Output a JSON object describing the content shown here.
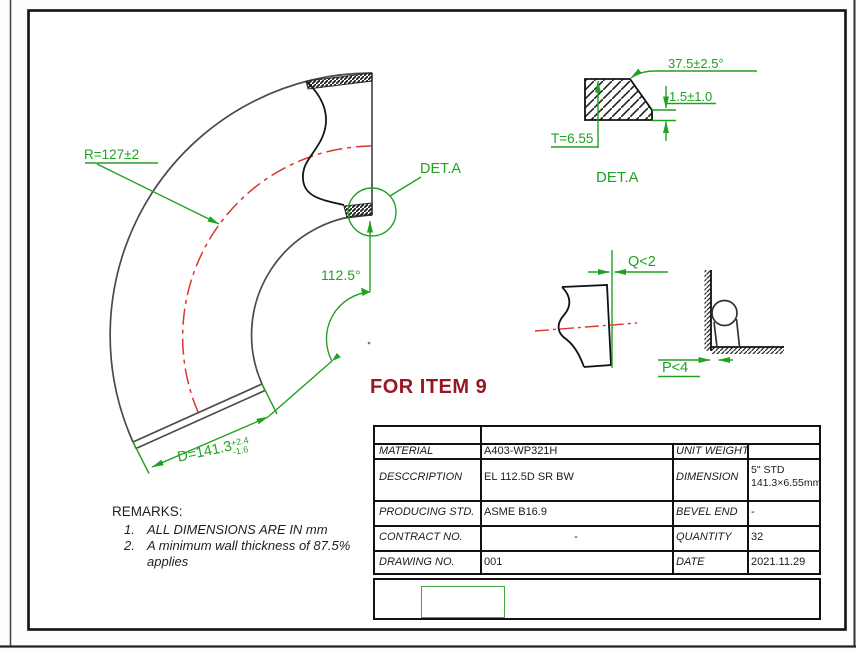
{
  "colors": {
    "dimension_green": "#21a121",
    "centerline_red": "#d9372e",
    "drawing_black": "#3a3a3a",
    "item_note_red": "#991722"
  },
  "main_view": {
    "radius_label": "R=127±2",
    "angle_label": "112.5°",
    "detail_ref_label": "DET.A",
    "diameter_label": "D=141.3",
    "diameter_tol_plus": "+2.4",
    "diameter_tol_minus": "-1.6"
  },
  "detail_view": {
    "bevel_angle_label": "37.5±2.5°",
    "root_face_label": "1.5±1.0",
    "thickness_label": "T=6.55",
    "title": "DET.A"
  },
  "tolerance_views": {
    "squareness_label": "Q<2",
    "flatness_label": "P<4"
  },
  "item_note": "FOR ITEM 9",
  "remarks": {
    "title": "REMARKS:",
    "items": [
      {
        "num": "1.",
        "text": "ALL DIMENSIONS ARE IN mm"
      },
      {
        "num": "2.",
        "text": "A minimum wall thickness of 87.5% applies"
      }
    ]
  },
  "spec_table": {
    "rows": [
      {
        "label": "MATERIAL",
        "value": "A403-WP321H",
        "label2": "UNIT WEIGHT",
        "value2": ""
      },
      {
        "label": "DESCCRIPTION",
        "value": "EL 112.5D SR BW",
        "label2": "DIMENSION",
        "value2_line1": "5\"  STD",
        "value2_line2": "141.3×6.55mm"
      },
      {
        "label": "PRODUCING STD.",
        "value": "ASME B16.9",
        "label2": "BEVEL END",
        "value2": "-"
      },
      {
        "label": "CONTRACT NO.",
        "value": "-",
        "label2": "QUANTITY",
        "value2": "32"
      },
      {
        "label": "DRAWING NO.",
        "value": "001",
        "label2": "DATE",
        "value2": "2021.11.29"
      }
    ]
  }
}
